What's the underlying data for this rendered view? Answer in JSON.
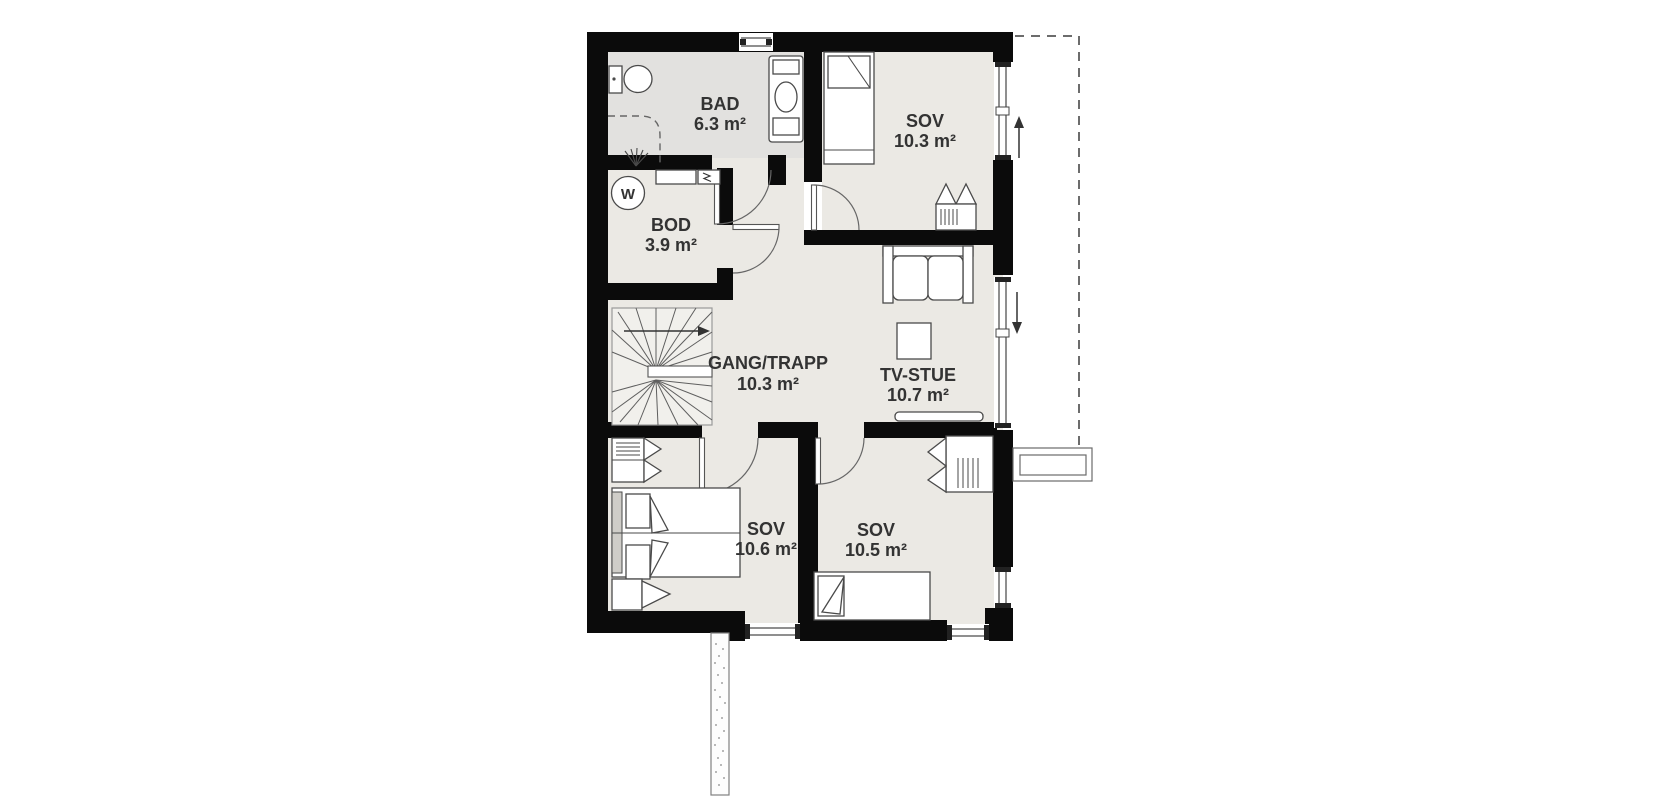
{
  "floorplan": {
    "rooms": [
      {
        "name": "BAD",
        "area": "6.3 m²"
      },
      {
        "name": "SOV",
        "area": "10.3 m²"
      },
      {
        "name": "BOD",
        "area": "3.9 m²"
      },
      {
        "name": "GANG/TRAPP",
        "area": "10.3 m²"
      },
      {
        "name": "TV-STUE",
        "area": "10.7 m²"
      },
      {
        "name": "SOV",
        "area": "10.6 m²"
      },
      {
        "name": "SOV",
        "area": "10.5 m²"
      }
    ],
    "symbols": {
      "water_heater_label": "W"
    },
    "colors": {
      "wall": "#0b0b0b",
      "floor": "#ebe9e4",
      "bad_floor": "#e2e1df",
      "text": "#333333"
    }
  }
}
